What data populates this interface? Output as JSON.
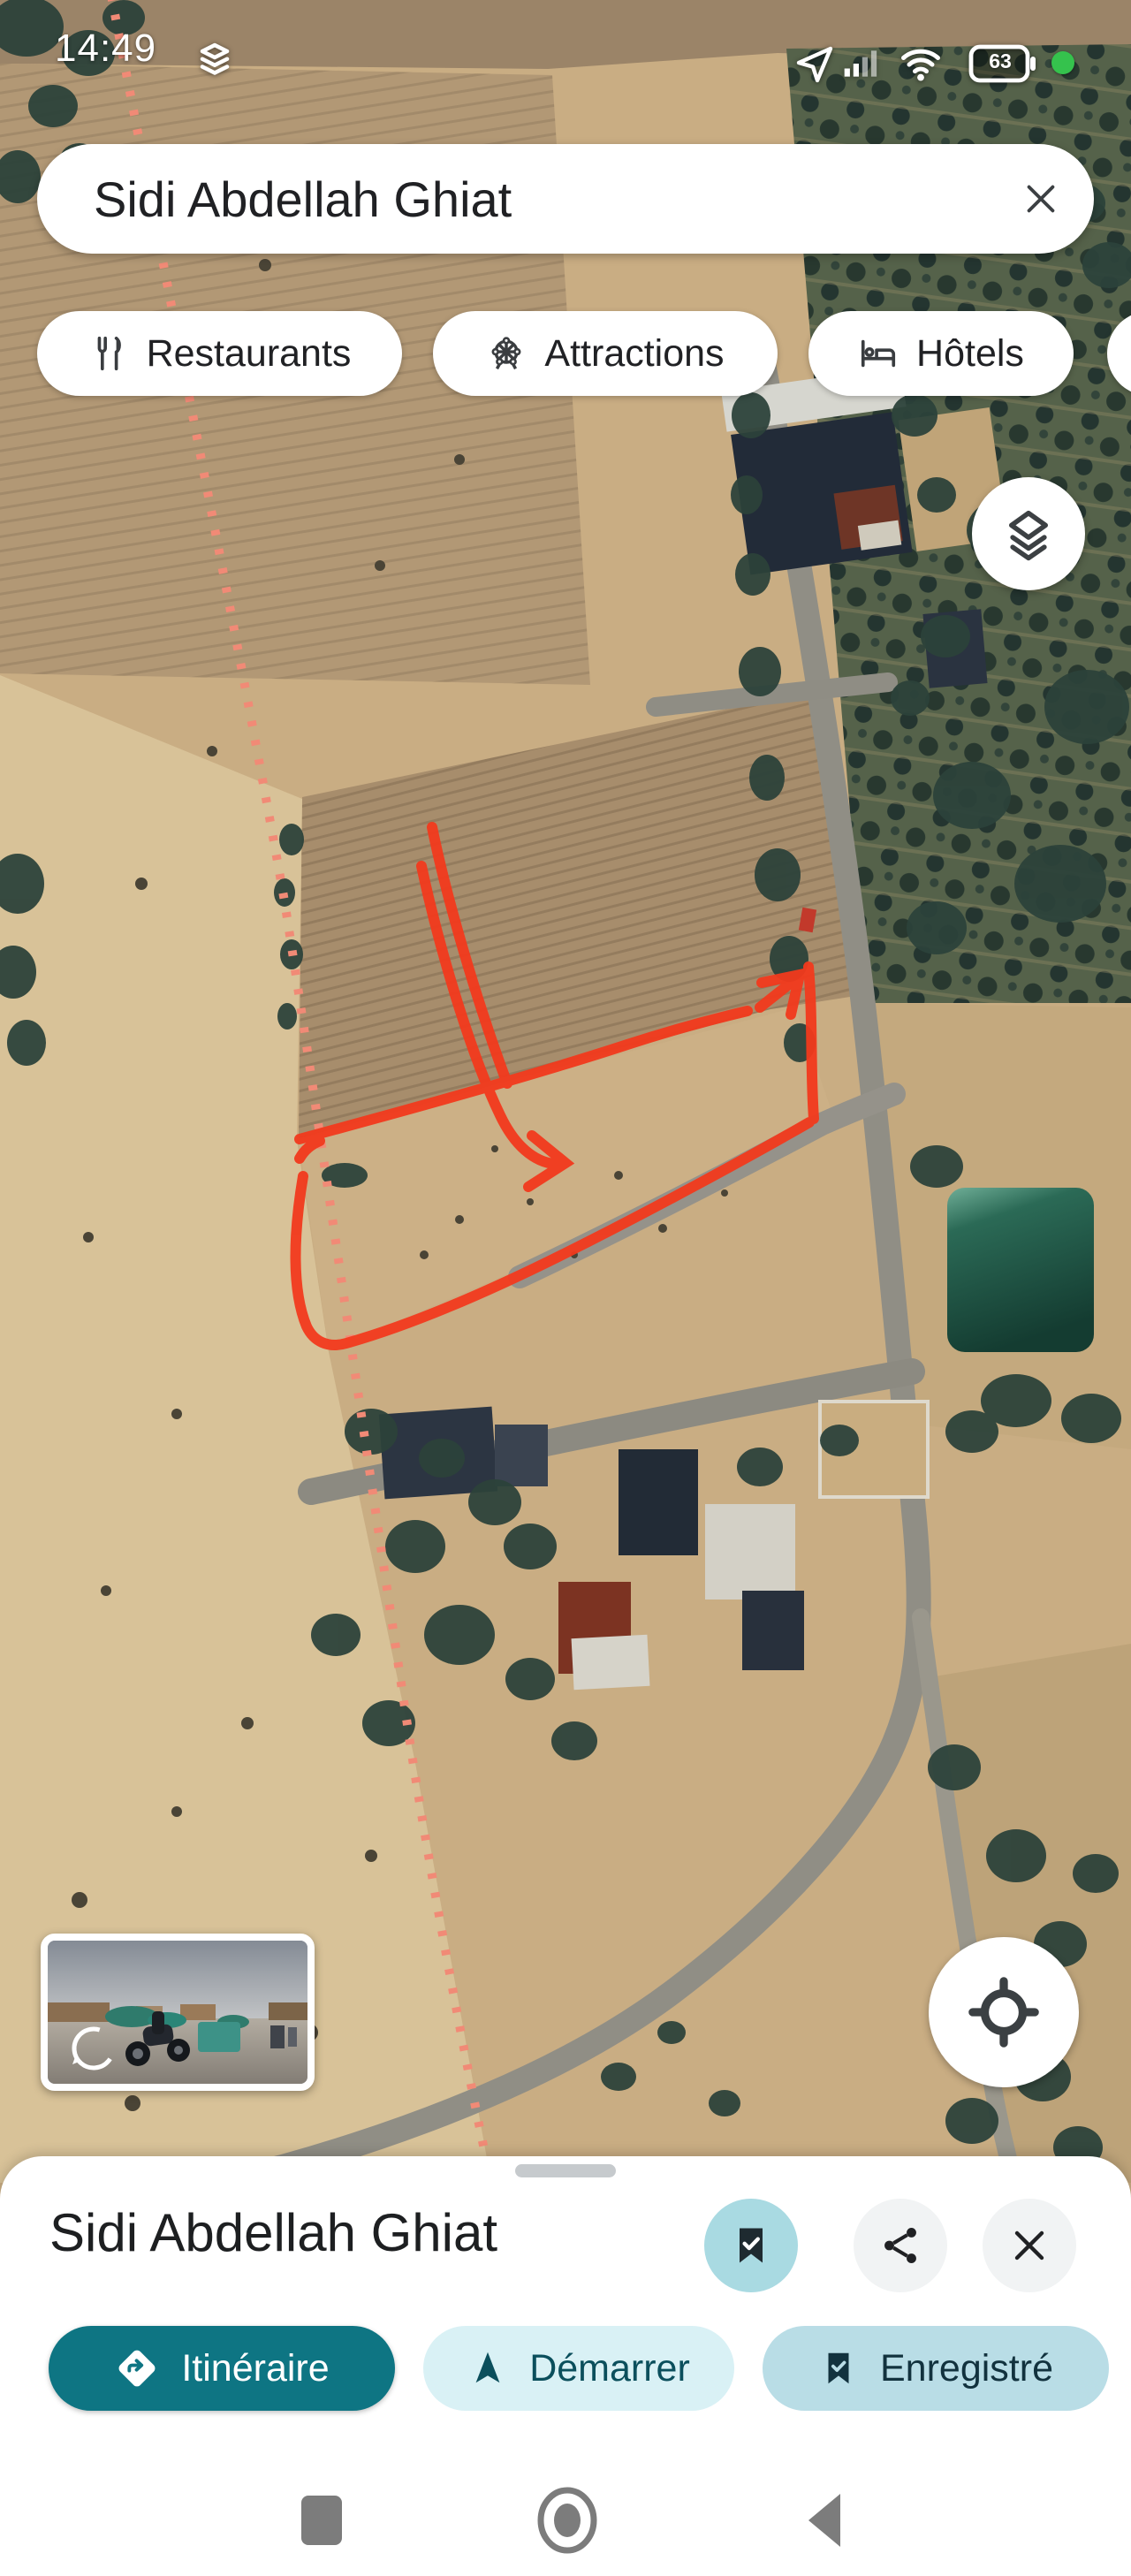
{
  "status_bar": {
    "time": "14:49",
    "battery_percent": "63",
    "icons": [
      "stacked-layers-icon",
      "location-share-icon",
      "cell-signal-icon",
      "wifi-icon",
      "battery-icon",
      "green-status-dot"
    ]
  },
  "search_bar": {
    "query": "Sidi Abdellah Ghiat"
  },
  "filter_chips": {
    "items": [
      {
        "label": "Restaurants",
        "icon": "restaurant-icon"
      },
      {
        "label": "Attractions",
        "icon": "attractions-icon"
      },
      {
        "label": "Hôtels",
        "icon": "hotel-icon"
      },
      {
        "label": "",
        "icon": "partial-chip-icon"
      }
    ]
  },
  "map": {
    "type": "satellite",
    "annotation": "hand-drawn red outline of a field plot with two long arrows pointing into it and a small arrow at its top-right corner",
    "annotation_color": "#f23a1d",
    "parcel_dotted_line_color": "#f18a76",
    "pond_color": "#1e4d40",
    "controls": {
      "layers_button": "layers-icon",
      "my_location_button": "crosshair-icon",
      "street_view_preview": "street-view-thumbnail"
    }
  },
  "place_sheet": {
    "title": "Sidi Abdellah Ghiat",
    "actions": [
      {
        "label": "Itinéraire",
        "icon": "directions-icon",
        "style": "filled-teal"
      },
      {
        "label": "Démarrer",
        "icon": "navigation-icon",
        "style": "light-cyan"
      },
      {
        "label": "Enregistré",
        "icon": "bookmark-check-icon",
        "style": "light-blue"
      }
    ]
  },
  "nav_bar": {
    "icons": [
      "recents-square-icon",
      "home-circle-icon",
      "back-triangle-icon"
    ]
  },
  "colors": {
    "accent_teal": "#0e7583",
    "light_cyan_chip": "#d9f1f5",
    "saved_chip_blue": "#b9dde6",
    "saved_badge_bg": "#a9dae2",
    "annotation_red": "#f23a1d",
    "battery_dot_green": "#35c24d"
  }
}
